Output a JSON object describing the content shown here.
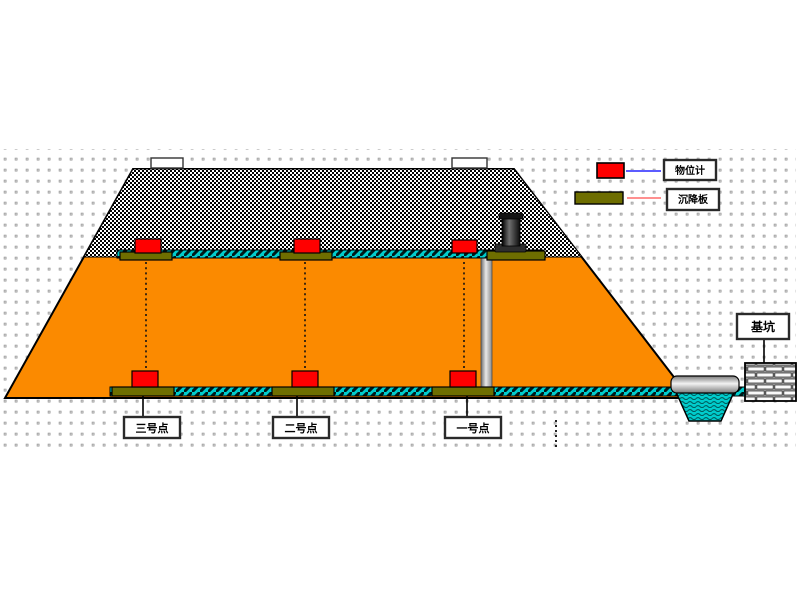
{
  "diagram": {
    "title_hint": "embankment-settlement-monitoring",
    "points": [
      {
        "label": "三号点"
      },
      {
        "label": "二号点"
      },
      {
        "label": "一号点"
      }
    ],
    "pit": {
      "label": "基坑"
    },
    "legend": [
      {
        "label": "物位计",
        "symbol": "level-gauge-red-box",
        "line_color": "#5c5cff"
      },
      {
        "label": "沉降板",
        "symbol": "settlement-plate-olive-bar",
        "line_color": "#ff9090"
      }
    ]
  },
  "colors": {
    "embankment": "#fb8a00",
    "rockfill": "#000000",
    "rope": "#00cccc",
    "sensor": "#ff0000",
    "plate": "#6e6e00",
    "water": "#00cccc",
    "legend_line_level": "#5c5cff",
    "legend_line_plate": "#ff9090",
    "grid_dot": "#c4c4c4"
  }
}
